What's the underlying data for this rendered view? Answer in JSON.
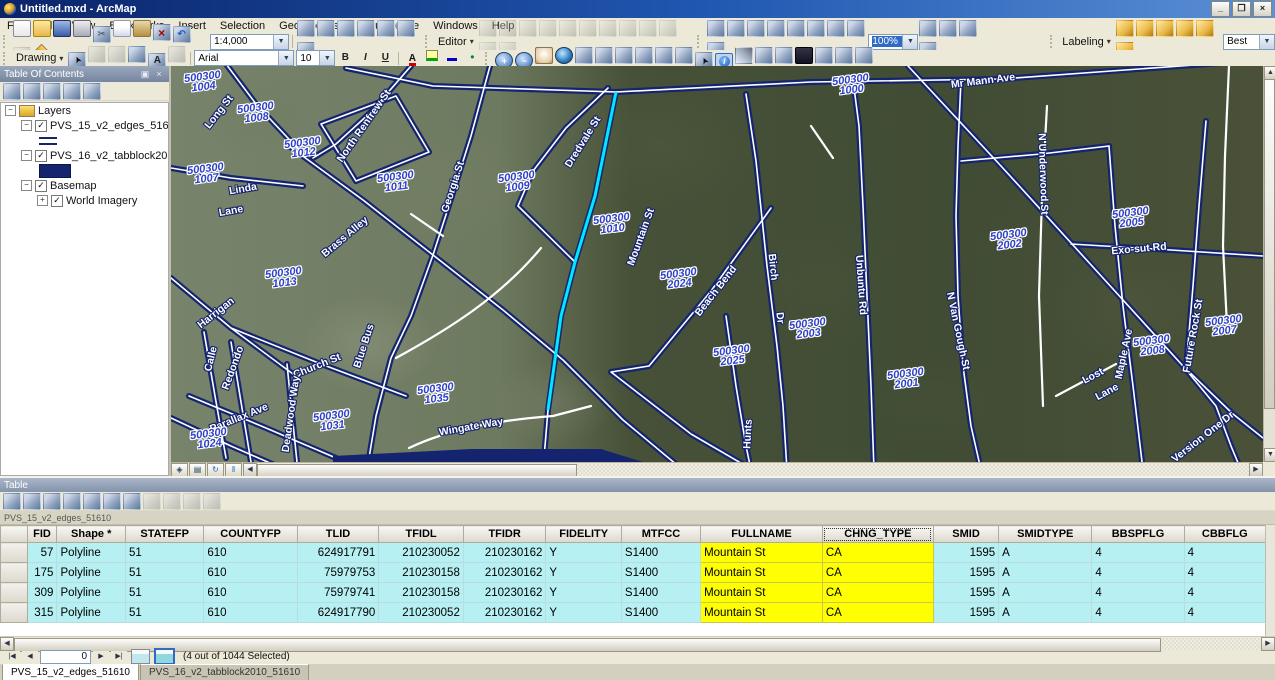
{
  "window": {
    "title": "Untitled.mxd - ArcMap",
    "minimize": "_",
    "restore": "❐",
    "close": "×"
  },
  "menu": {
    "items": [
      "File",
      "Edit",
      "View",
      "Bookmarks",
      "Insert",
      "Selection",
      "Geoprocessing",
      "Customize",
      "Windows",
      "Help"
    ]
  },
  "toolbar1": {
    "scale_value": "1:4,000",
    "editor_label": "Editor",
    "zoom_percent": "100%",
    "labeling_label": "Labeling",
    "label_quality": "Best",
    "icons_standard": [
      {
        "n": "new"
      },
      {
        "n": "open"
      },
      {
        "n": "save"
      },
      {
        "n": "print"
      },
      {
        "n": "cut"
      },
      {
        "n": "copy"
      },
      {
        "n": "paste"
      },
      {
        "n": "delete"
      },
      {
        "n": "undo"
      },
      {
        "n": "redo",
        "d": true
      },
      {
        "n": "add-data"
      }
    ],
    "icons_windows": [
      {
        "n": "map-scale-settings"
      },
      {
        "n": "table-of-contents-window"
      },
      {
        "n": "catalog-window"
      },
      {
        "n": "search-window"
      },
      {
        "n": "arctoolbox-window"
      },
      {
        "n": "python-window"
      },
      {
        "n": "model-builder"
      }
    ],
    "icons_editor": [
      {
        "n": "edit-tool",
        "d": true
      },
      {
        "n": "edit-annotation-tool",
        "d": true
      },
      {
        "n": "straight-segment",
        "d": true
      },
      {
        "n": "endpoint-arc",
        "d": true
      },
      {
        "n": "trace-tool",
        "d": true
      },
      {
        "n": "point-tool",
        "d": true
      },
      {
        "n": "edit-vertices",
        "d": true
      },
      {
        "n": "reshape",
        "d": true
      },
      {
        "n": "cut-polygons",
        "d": true
      },
      {
        "n": "split-tool",
        "d": true
      },
      {
        "n": "rotate-tool",
        "d": true
      },
      {
        "n": "attributes-dialog",
        "d": true
      }
    ],
    "icons_georef": [
      {
        "n": "add-control-points"
      },
      {
        "n": "auto-adjust"
      },
      {
        "n": "pan-georeference"
      },
      {
        "n": "zoom-georeference"
      },
      {
        "n": "viewer-link"
      },
      {
        "n": "grid-view"
      },
      {
        "n": "split-view"
      },
      {
        "n": "link-table"
      },
      {
        "n": "update-georeferencing"
      }
    ],
    "icons_after_zoom": [
      {
        "n": "page-layout"
      },
      {
        "n": "data-driven-pages"
      },
      {
        "n": "publish-service"
      },
      {
        "n": "export-map"
      }
    ],
    "icons_labeling": [
      {
        "n": "label-manager"
      },
      {
        "n": "label-priority"
      },
      {
        "n": "label-weight"
      },
      {
        "n": "lock-labels"
      },
      {
        "n": "pause-labeling"
      },
      {
        "n": "view-unplaced"
      }
    ]
  },
  "toolbar2": {
    "drawing_label": "Drawing",
    "font_name": "Arial",
    "font_size": "10",
    "bold": "B",
    "italic": "I",
    "underline": "U",
    "icons_drawing": [
      {
        "n": "select-elements"
      },
      {
        "n": "rotate-element",
        "d": true
      },
      {
        "n": "zoom-to-selected-elements",
        "d": true
      },
      {
        "n": "rectangle-shape"
      },
      {
        "n": "text"
      },
      {
        "n": "edit-vertices-drawing",
        "d": true
      }
    ],
    "icons_colors": [
      {
        "n": "font-color"
      },
      {
        "n": "fill-color"
      },
      {
        "n": "line-color"
      },
      {
        "n": "marker-color"
      }
    ],
    "icons_nav": [
      {
        "n": "zoom-in"
      },
      {
        "n": "zoom-out"
      },
      {
        "n": "pan"
      },
      {
        "n": "full-extent"
      },
      {
        "n": "fixed-zoom-in"
      },
      {
        "n": "fixed-zoom-out"
      },
      {
        "n": "go-back-extent"
      },
      {
        "n": "go-forward-extent"
      },
      {
        "n": "select-features"
      },
      {
        "n": "clear-selected-features"
      },
      {
        "n": "select-elements"
      },
      {
        "n": "identify",
        "p": true
      },
      {
        "n": "measure"
      },
      {
        "n": "html-popup"
      },
      {
        "n": "go-to-xy"
      },
      {
        "n": "find"
      },
      {
        "n": "hyperlink"
      },
      {
        "n": "time-slider"
      },
      {
        "n": "create-viewer-window"
      }
    ]
  },
  "toc": {
    "title": "Table Of Contents",
    "tool_icons": [
      {
        "n": "list-by-drawing-order"
      },
      {
        "n": "list-by-source"
      },
      {
        "n": "list-by-visibility"
      },
      {
        "n": "list-by-selection"
      },
      {
        "n": "toc-options"
      }
    ],
    "nodes": [
      {
        "label": "Layers",
        "level": 0,
        "expander": "-",
        "icon": "layers"
      },
      {
        "label": "PVS_15_v2_edges_51610",
        "level": 1,
        "expander": "-",
        "checked": true
      },
      {
        "symbol": "line",
        "level": 2
      },
      {
        "label": "PVS_16_v2_tabblock2010_51610",
        "level": 1,
        "expander": "-",
        "checked": true
      },
      {
        "symbol": "fill",
        "level": 2
      },
      {
        "label": "Basemap",
        "level": 1,
        "expander": "-",
        "checked": true
      },
      {
        "label": "World Imagery",
        "level": 2,
        "expander": "+",
        "checked": true
      }
    ]
  },
  "map": {
    "selected_street": "Mountain St",
    "selection_color": "#00e8ff",
    "edge_color": "#14246e",
    "block_labels": [
      {
        "code": "500300",
        "unit": "1004",
        "x": 32,
        "y": 16
      },
      {
        "code": "500300",
        "unit": "1008",
        "x": 85,
        "y": 47
      },
      {
        "code": "500300",
        "unit": "1012",
        "x": 132,
        "y": 82
      },
      {
        "code": "500300",
        "unit": "1007",
        "x": 35,
        "y": 108
      },
      {
        "code": "500300",
        "unit": "1011",
        "x": 225,
        "y": 116
      },
      {
        "code": "500300",
        "unit": "1009",
        "x": 346,
        "y": 116
      },
      {
        "code": "500300",
        "unit": "1000",
        "x": 680,
        "y": 19
      },
      {
        "code": "500300",
        "unit": "1010",
        "x": 441,
        "y": 158
      },
      {
        "code": "500300",
        "unit": "2002",
        "x": 838,
        "y": 174
      },
      {
        "code": "500300",
        "unit": "2005",
        "x": 960,
        "y": 152
      },
      {
        "code": "500300",
        "unit": "1013",
        "x": 113,
        "y": 212
      },
      {
        "code": "500300",
        "unit": "2024",
        "x": 508,
        "y": 213
      },
      {
        "code": "500300",
        "unit": "2025",
        "x": 561,
        "y": 290
      },
      {
        "code": "500300",
        "unit": "2003",
        "x": 637,
        "y": 263
      },
      {
        "code": "500300",
        "unit": "2001",
        "x": 735,
        "y": 313
      },
      {
        "code": "500300",
        "unit": "2007",
        "x": 1053,
        "y": 260
      },
      {
        "code": "500300",
        "unit": "2008",
        "x": 981,
        "y": 280
      },
      {
        "code": "500300",
        "unit": "1031",
        "x": 161,
        "y": 355
      },
      {
        "code": "500300",
        "unit": "1024",
        "x": 38,
        "y": 373
      },
      {
        "code": "500300",
        "unit": "1035",
        "x": 265,
        "y": 328
      }
    ],
    "street_labels": [
      {
        "text": "Long St",
        "x": 48,
        "y": 46,
        "rot": -52
      },
      {
        "text": "North Renfrew St",
        "x": 193,
        "y": 60,
        "rot": -55
      },
      {
        "text": "Georgia St",
        "x": 282,
        "y": 121,
        "rot": -72
      },
      {
        "text": "Linda",
        "x": 72,
        "y": 123,
        "rot": -10
      },
      {
        "text": "Lane",
        "x": 60,
        "y": 145,
        "rot": -10
      },
      {
        "text": "Brass Alley",
        "x": 174,
        "y": 171,
        "rot": -40
      },
      {
        "text": "Dredvale St",
        "x": 412,
        "y": 76,
        "rot": -58
      },
      {
        "text": "Mountain St",
        "x": 470,
        "y": 171,
        "rot": -70
      },
      {
        "text": "Mr Mann Ave",
        "x": 812,
        "y": 15,
        "rot": -7
      },
      {
        "text": "N Underwood St",
        "x": 872,
        "y": 108,
        "rot": 88
      },
      {
        "text": "Exo-sut Rd",
        "x": 968,
        "y": 183,
        "rot": -5
      },
      {
        "text": "Harrigan",
        "x": 45,
        "y": 247,
        "rot": -38
      },
      {
        "text": "Calle",
        "x": 40,
        "y": 293,
        "rot": -76
      },
      {
        "text": "Redondo",
        "x": 62,
        "y": 302,
        "rot": -70
      },
      {
        "text": "Church St",
        "x": 146,
        "y": 300,
        "rot": -22
      },
      {
        "text": "Blue Bus",
        "x": 193,
        "y": 280,
        "rot": -72
      },
      {
        "text": "Parallax Ave",
        "x": 68,
        "y": 352,
        "rot": -22
      },
      {
        "text": "Deadwood Way",
        "x": 120,
        "y": 348,
        "rot": -82
      },
      {
        "text": "Wingate  Way",
        "x": 300,
        "y": 361,
        "rot": -10
      },
      {
        "text": "Beach Bend",
        "x": 545,
        "y": 225,
        "rot": -52
      },
      {
        "text": "Birch",
        "x": 602,
        "y": 201,
        "rot": 84
      },
      {
        "text": "Dr",
        "x": 609,
        "y": 252,
        "rot": 84
      },
      {
        "text": "Hunts",
        "x": 577,
        "y": 368,
        "rot": -87
      },
      {
        "text": "St",
        "x": 585,
        "y": 404,
        "rot": -87
      },
      {
        "text": "Unbuntu Rd",
        "x": 690,
        "y": 219,
        "rot": 86
      },
      {
        "text": "N Van Gough St",
        "x": 787,
        "y": 265,
        "rot": 78
      },
      {
        "text": "Lost",
        "x": 922,
        "y": 310,
        "rot": -28
      },
      {
        "text": "Lane",
        "x": 936,
        "y": 326,
        "rot": -28
      },
      {
        "text": "Maple Ave",
        "x": 953,
        "y": 288,
        "rot": -78
      },
      {
        "text": "Future Rock St",
        "x": 1022,
        "y": 270,
        "rot": -80
      },
      {
        "text": "Version One Dr",
        "x": 1032,
        "y": 371,
        "rot": -38
      }
    ]
  },
  "table": {
    "title": "Table",
    "source_label": "PVS_15_v2_edges_51610",
    "tool_icons": [
      {
        "n": "table-options"
      },
      {
        "n": "related-tables"
      },
      {
        "n": "select-by-attributes"
      },
      {
        "n": "switch-selection"
      },
      {
        "n": "clear-selection"
      },
      {
        "n": "zoom-to-selected"
      },
      {
        "n": "delete-selected"
      },
      {
        "n": "copy-rows",
        "d": true
      },
      {
        "n": "paste-rows",
        "d": true
      },
      {
        "n": "field-calculator",
        "d": true
      },
      {
        "n": "delete-field",
        "d": true
      }
    ],
    "columns": [
      {
        "label": "",
        "w": 27,
        "align": "left"
      },
      {
        "label": "FID",
        "w": 30,
        "align": "right"
      },
      {
        "label": "Shape *",
        "w": 69,
        "align": "left"
      },
      {
        "label": "STATEFP",
        "w": 79,
        "align": "left"
      },
      {
        "label": "COUNTYFP",
        "w": 94,
        "align": "left"
      },
      {
        "label": "TLID",
        "w": 82,
        "align": "right"
      },
      {
        "label": "TFIDL",
        "w": 85,
        "align": "right"
      },
      {
        "label": "TFIDR",
        "w": 83,
        "align": "right"
      },
      {
        "label": "FIDELITY",
        "w": 76,
        "align": "left"
      },
      {
        "label": "MTFCC",
        "w": 80,
        "align": "left"
      },
      {
        "label": "FULLNAME",
        "w": 123,
        "align": "left",
        "yellow": true
      },
      {
        "label": "CHNG_TYPE",
        "w": 112,
        "align": "left",
        "yellow": true,
        "selected": true
      },
      {
        "label": "SMID",
        "w": 66,
        "align": "right"
      },
      {
        "label": "SMIDTYPE",
        "w": 94,
        "align": "left"
      },
      {
        "label": "BBSPFLG",
        "w": 93,
        "align": "left"
      },
      {
        "label": "CBBFLG",
        "w": 82,
        "align": "left"
      }
    ],
    "rows": [
      [
        "57",
        "Polyline",
        "51",
        "610",
        "624917791",
        "210230052",
        "210230162",
        "Y",
        "S1400",
        "Mountain St",
        "CA",
        "1595",
        "A",
        "4",
        "4"
      ],
      [
        "175",
        "Polyline",
        "51",
        "610",
        "75979753",
        "210230158",
        "210230162",
        "Y",
        "S1400",
        "Mountain St",
        "CA",
        "1595",
        "A",
        "4",
        "4"
      ],
      [
        "309",
        "Polyline",
        "51",
        "610",
        "75979741",
        "210230158",
        "210230162",
        "Y",
        "S1400",
        "Mountain St",
        "CA",
        "1595",
        "A",
        "4",
        "4"
      ],
      [
        "315",
        "Polyline",
        "51",
        "610",
        "624917790",
        "210230052",
        "210230162",
        "Y",
        "S1400",
        "Mountain St",
        "CA",
        "1595",
        "A",
        "4",
        "4"
      ]
    ],
    "nav": {
      "record_value": "0",
      "status": "(4 out of 1044 Selected)"
    },
    "sheet_tabs": [
      {
        "label": "PVS_15_v2_edges_51610",
        "active": true
      },
      {
        "label": "PVS_16_v2_tabblock2010_51610",
        "active": false
      }
    ]
  }
}
